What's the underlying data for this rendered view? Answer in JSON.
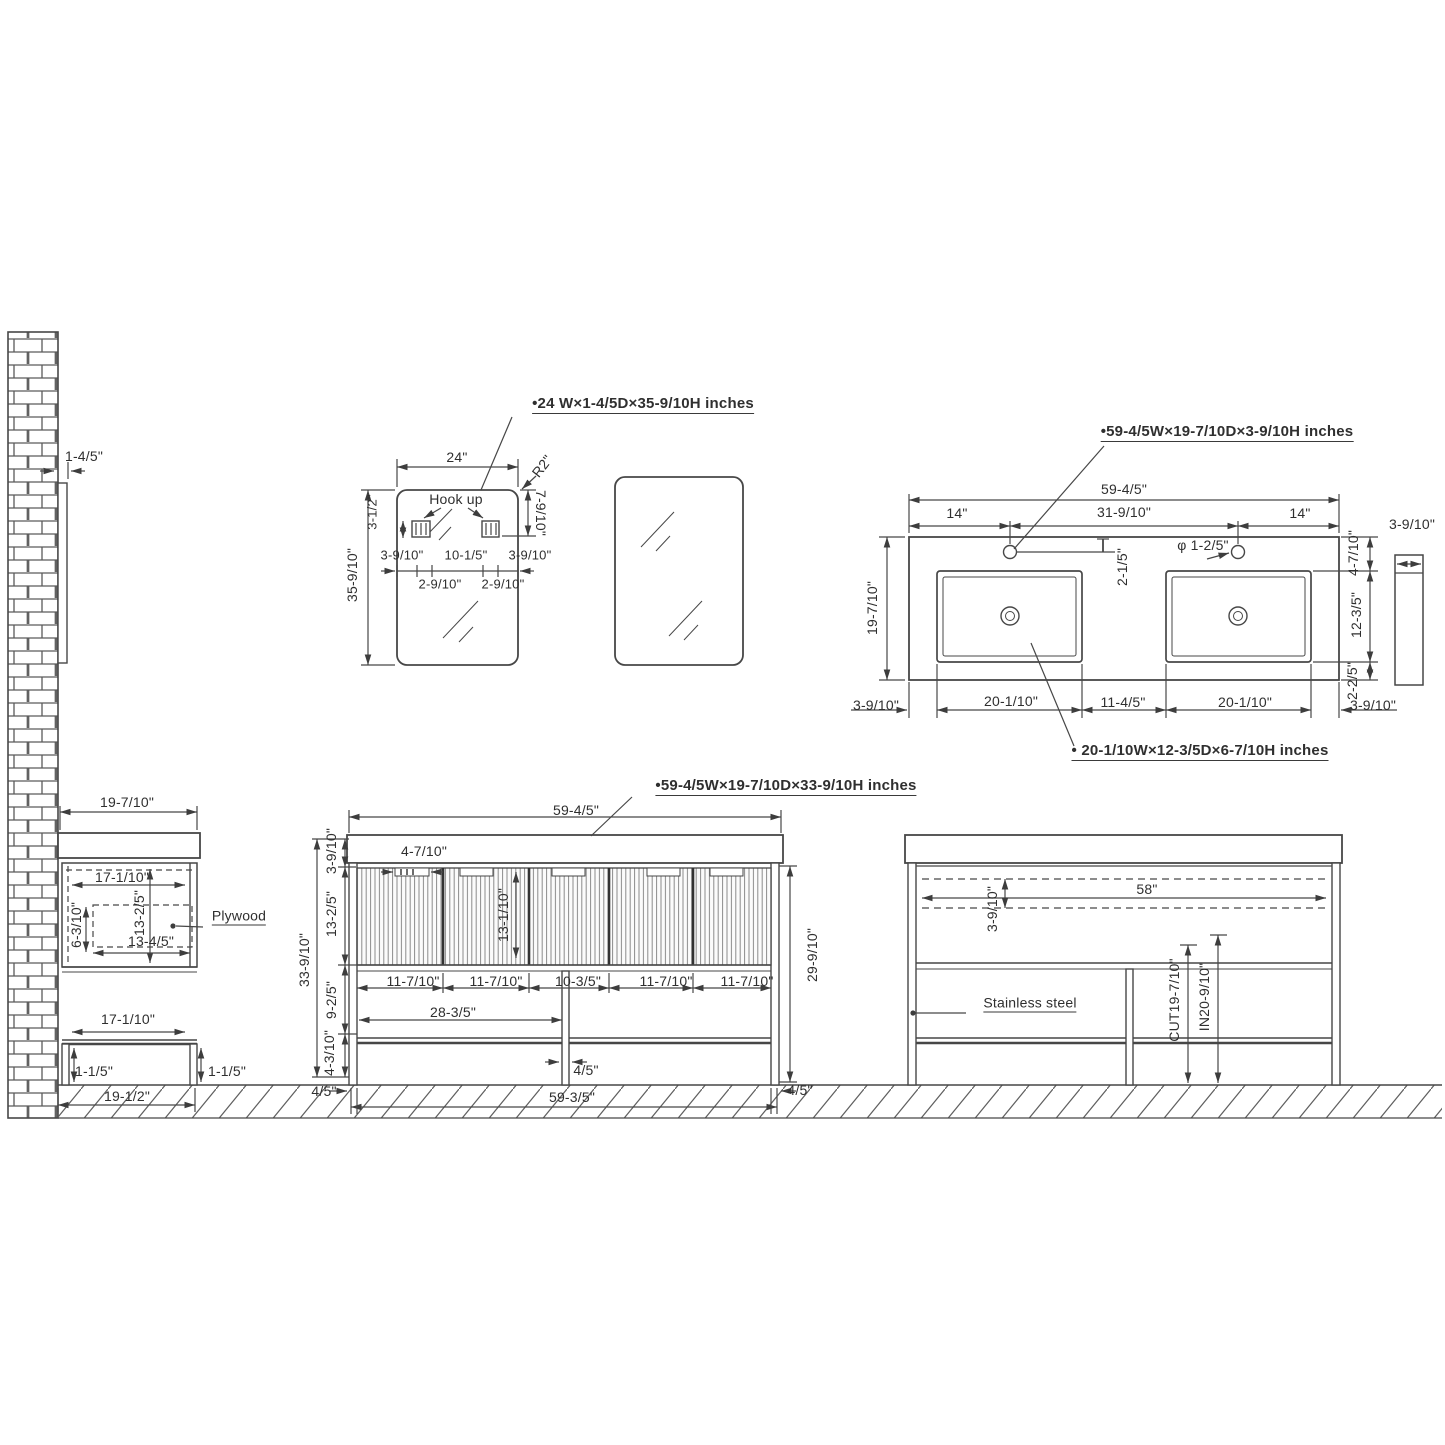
{
  "drawing": {
    "wall": {
      "gap": "1-4/5\""
    },
    "mirror": {
      "title": "•24 W×1-4/5D×35-9/10H inches",
      "w24": "24\"",
      "r2": "R2\"",
      "v7910": "7-9/10\"",
      "v312": "3-1/2\"",
      "h35910": "35-9/10\"",
      "hookup": "Hook up",
      "t3910a": "3-9/10\"",
      "t1015": "10-1/5\"",
      "t3910b": "3-9/10\"",
      "t2910a": "2-9/10\"",
      "t2910b": "2-9/10\""
    },
    "counter": {
      "title": "•59-4/5W×19-7/10D×3-9/10H inches",
      "sink_label": "• 20-1/10W×12-3/5D×6-7/10H inches",
      "w5945": "59-4/5\"",
      "d14l": "14\"",
      "d31910": "31-9/10\"",
      "d14r": "14\"",
      "v215": "2-1/5\"",
      "phi": "φ 1-2/5\"",
      "v19710": "19-7/10\"",
      "v4710": "4-7/10\"",
      "v1235": "12-3/5\"",
      "v225": "2-2/5\"",
      "side3910": "3-9/10\"",
      "b3910l": "3-9/10\"",
      "b20110l": "20-1/10\"",
      "b1145": "11-4/5\"",
      "b20110r": "20-1/10\"",
      "b3910r": "3-9/10\""
    },
    "side": {
      "d19710": "19-7/10\"",
      "top17110": "17-1/10\"",
      "v1325": "13-2/5\"",
      "v6310": "6-3/10\"",
      "w1345": "13-4/5\"",
      "plywood": "Plywood",
      "bot17110": "17-1/10\"",
      "leg115l": "1-1/5\"",
      "leg115r": "1-1/5\"",
      "base1912": "19-1/2\""
    },
    "front": {
      "title": "•59-4/5W×19-7/10D×33-9/10H inches",
      "w5945": "59-4/5\"",
      "n4710": "4-7/10\"",
      "v3910": "3-9/10\"",
      "v1325": "13-2/5\"",
      "v13110": "13-1/10\"",
      "v925": "9-2/5\"",
      "v4310": "4-3/10\"",
      "v33910": "33-9/10\"",
      "v29910": "29-9/10\"",
      "s1": "11-7/10\"",
      "s2": "11-7/10\"",
      "s3": "10-3/5\"",
      "s4": "11-7/10\"",
      "s5": "11-7/10\"",
      "h2835": "28-3/5\"",
      "p45": "4/5\"",
      "f45l": "4/5\"",
      "base5935": "59-3/5\"",
      "f45r": "4/5\""
    },
    "rear": {
      "w58": "58\"",
      "v3910": "3-9/10\"",
      "steel": "Stainless steel",
      "cut": "CUT19-7/10\"",
      "inn": "IN20-9/10\""
    }
  }
}
